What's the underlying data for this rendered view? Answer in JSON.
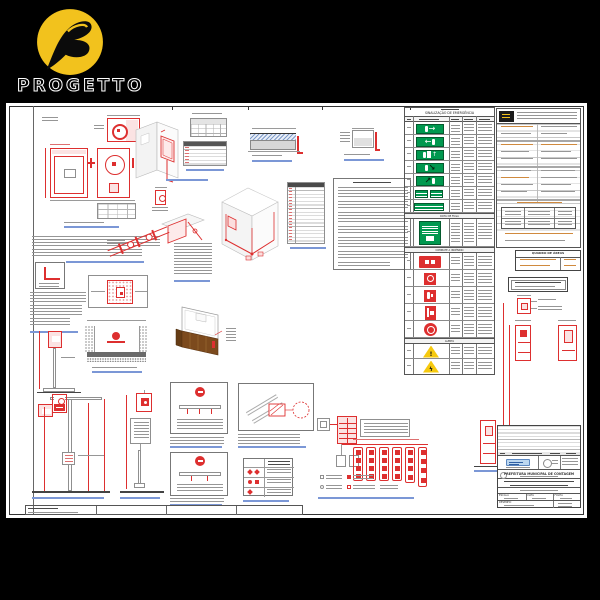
{
  "brand": {
    "name": "PROGETTO"
  },
  "palette": {
    "cad_red": "#dd2f2f",
    "sign_green": "#00984f",
    "logo_yellow": "#f2c21d",
    "warning_yellow": "#f6c90e",
    "caption_blue": "#7b97d6",
    "table_orange": "#d08a3e",
    "counter_brown": "#7c4a1d"
  },
  "signage_table": {
    "title": "SINALIZAÇÃO DE EMERGÊNCIA",
    "subtitle": "ROTA DE FUGA",
    "section_equip": "COMBATE A INCÊNDIO",
    "section_alert": "ALERTA",
    "rows_green": [
      "exit-right",
      "exit-left",
      "exit-door-up",
      "exit-diag-down",
      "exit-diag-up",
      "exit-double-small",
      "exit-wide"
    ],
    "route_map_row": "planta-rota-de-fuga",
    "rows_red": [
      "fire-hose-cabinet",
      "alarm-button",
      "extinguisher",
      "hydrant-door",
      "hose-reel"
    ],
    "rows_warning": [
      "general-warning",
      "electric-risk"
    ]
  },
  "areas_table": {
    "title": "QUADRO DE ÁREAS"
  },
  "title_block": {
    "authority": "PREFEITURA MUNICIPAL DE CONTAGEM",
    "fields": {
      "scale": "ESCALA",
      "date": "DATA",
      "sheet": "FOLHA",
      "drawing": "DESENHO"
    }
  }
}
